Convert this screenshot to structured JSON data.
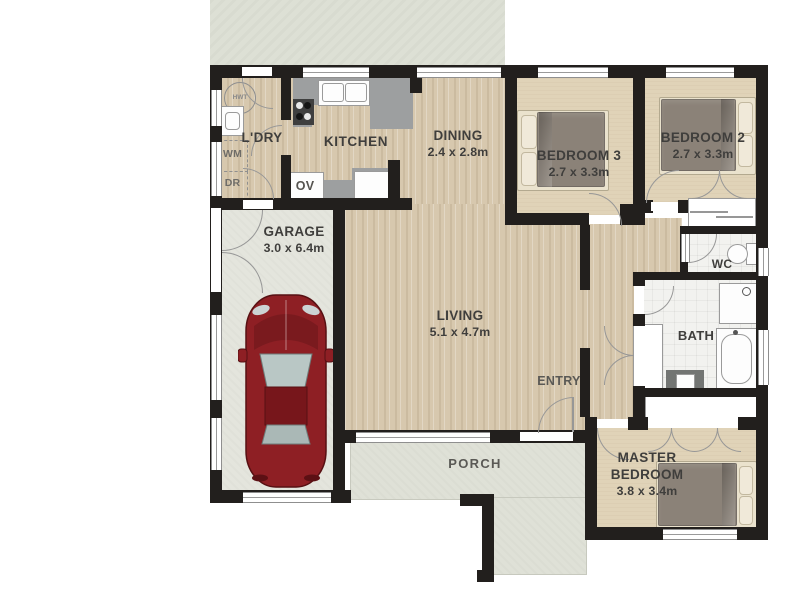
{
  "plan_title": "single-storey house floor plan",
  "rooms": {
    "laundry": {
      "name": "L'DRY"
    },
    "kitchen": {
      "name": "KITCHEN"
    },
    "dining": {
      "name": "DINING",
      "dims": "2.4 x 2.8m"
    },
    "bedroom3": {
      "name": "BEDROOM 3",
      "dims": "2.7 x 3.3m"
    },
    "bedroom2": {
      "name": "BEDROOM 2",
      "dims": "2.7 x 3.3m"
    },
    "garage": {
      "name": "GARAGE",
      "dims": "3.0 x 6.4m"
    },
    "living": {
      "name": "LIVING",
      "dims": "5.1 x 4.7m"
    },
    "master": {
      "name": "MASTER BEDROOM",
      "dims": "3.8 x 3.4m"
    },
    "bath": {
      "name": "BATH"
    },
    "wc": {
      "name": "WC"
    },
    "entry": {
      "name": "ENTRY"
    },
    "porch": {
      "name": "PORCH"
    }
  },
  "fixtures": {
    "hwt": "HWT",
    "wm": "WM",
    "dr": "DR",
    "ov": "OV"
  },
  "colors": {
    "wall": "#221f1d",
    "wood": "#d7c8ae",
    "carpet": "#e0d3b8",
    "concrete": "#e4e5dd",
    "porch": "#dfe1d7",
    "yard": "#dde0d5",
    "tile": "#f2f2ef",
    "counter": "#9d9fa0",
    "duvet": "#8b8278",
    "pillow": "#f0e9d9",
    "car": "#8e1f24",
    "text": "#3f3e3c",
    "fixture_line": "#9a9a9a"
  }
}
